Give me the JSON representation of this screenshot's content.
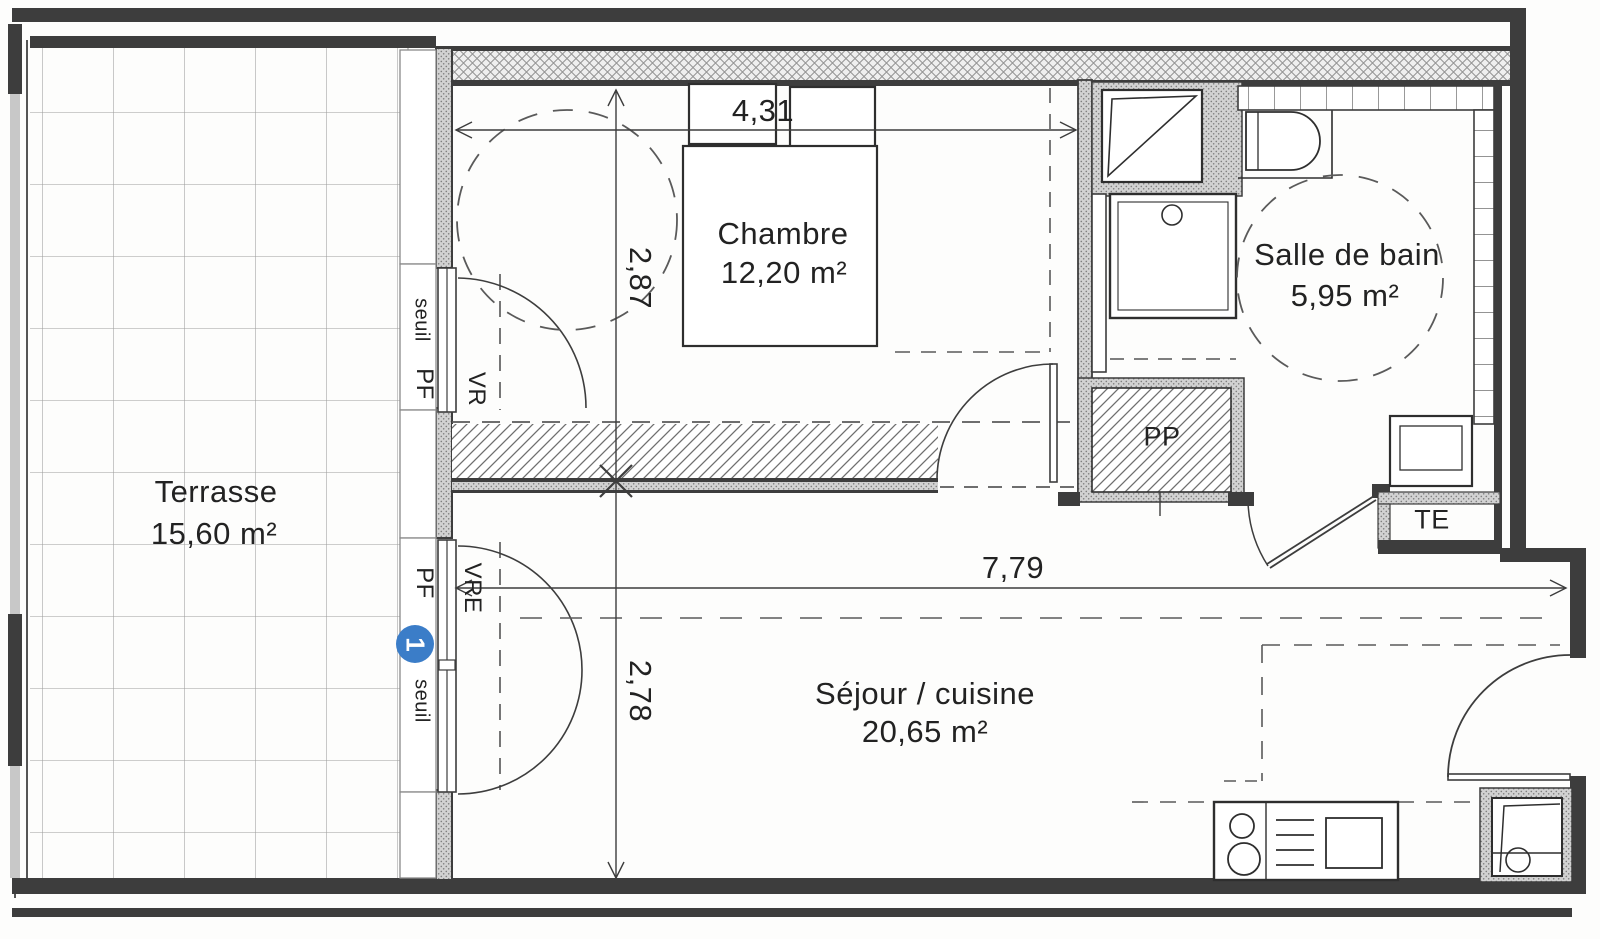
{
  "plan": {
    "rooms": {
      "terrasse": {
        "name": "Terrasse",
        "area": "15,60 m²"
      },
      "chambre": {
        "name": "Chambre",
        "area": "12,20 m²"
      },
      "salle_de_bain": {
        "name": "Salle de bain",
        "area": "5,95 m²"
      },
      "sejour_cuisine": {
        "name": "Séjour / cuisine",
        "area": "20,65 m²"
      }
    },
    "storage": {
      "pp": "PP",
      "te": "TE"
    },
    "dimensions": {
      "chambre_width_m": "4,31",
      "chambre_depth_m": "2,87",
      "sejour_width_m": "7,79",
      "sejour_depth_m": "2,78"
    },
    "openings": {
      "seuil_top": "seuil",
      "pf_top": "PF",
      "vr": "VR",
      "pf_bottom": "PF",
      "vre": "VRE",
      "seuil_bottom": "seuil"
    },
    "marker_1": "1",
    "colors": {
      "marker_blue": "#3b7dc8",
      "ink": "#3d3d3d"
    }
  }
}
